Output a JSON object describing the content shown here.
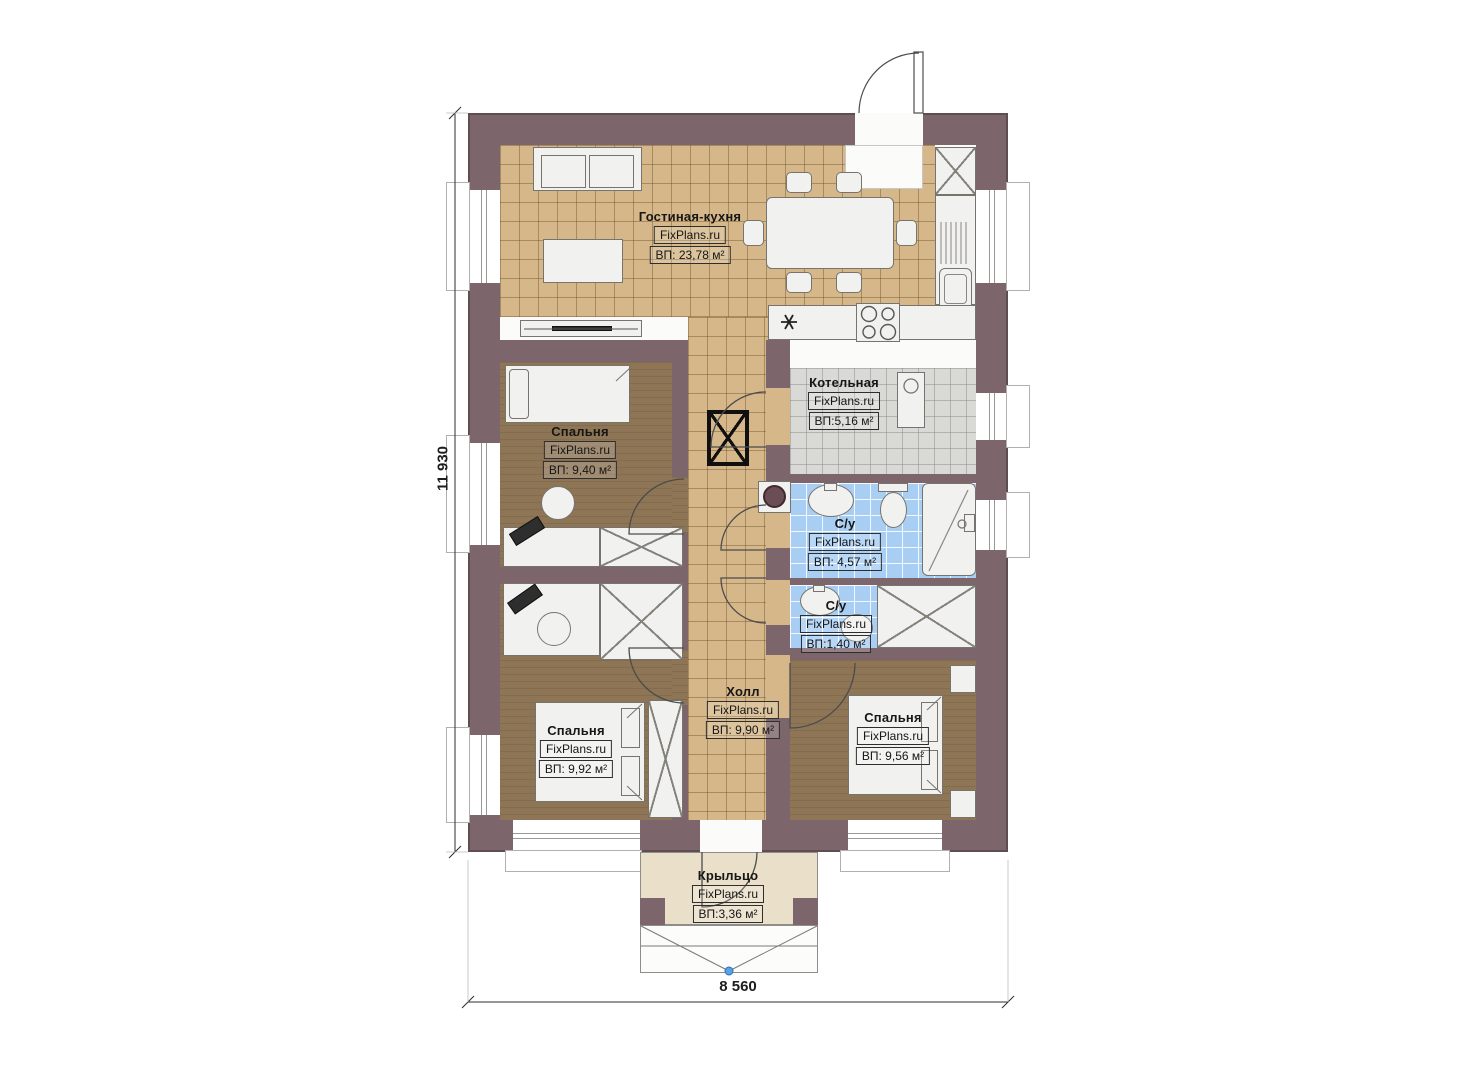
{
  "plan": {
    "dimensions": {
      "height_label": "11 930",
      "width_label": "8 560"
    },
    "colors": {
      "wall": "#7c666b",
      "wall_edge": "#5e4d52",
      "floor_tile_tan": "#d5b78a",
      "floor_bedroom": "#8d7555",
      "floor_bath": "#a9cef3",
      "floor_boiler": "#d9d9d6",
      "floor_porch": "#eadfc9",
      "furniture": "#f1f1ef",
      "accent_dot": "#58a0e8"
    }
  },
  "rooms": [
    {
      "id": "living-kitchen",
      "name": "Гостиная-кухня",
      "watermark": "FixPlans.ru",
      "area": "ВП: 23,78 м²"
    },
    {
      "id": "bedroom-top-left",
      "name": "Спальня",
      "watermark": "FixPlans.ru",
      "area": "ВП: 9,40 м²"
    },
    {
      "id": "boiler-room",
      "name": "Котельная",
      "watermark": "FixPlans.ru",
      "area": "ВП:5,16 м²"
    },
    {
      "id": "bathroom-large",
      "name": "С/у",
      "watermark": "FixPlans.ru",
      "area": "ВП: 4,57 м²"
    },
    {
      "id": "bathroom-small",
      "name": "С/у",
      "watermark": "FixPlans.ru",
      "area": "ВП:1,40 м²"
    },
    {
      "id": "hall",
      "name": "Холл",
      "watermark": "FixPlans.ru",
      "area": "ВП: 9,90 м²"
    },
    {
      "id": "bedroom-bottom-left",
      "name": "Спальня",
      "watermark": "FixPlans.ru",
      "area": "ВП: 9,92 м²"
    },
    {
      "id": "bedroom-bottom-right",
      "name": "Спальня",
      "watermark": "FixPlans.ru",
      "area": "ВП: 9,56 м²"
    },
    {
      "id": "porch",
      "name": "Крыльцо",
      "watermark": "FixPlans.ru",
      "area": "ВП:3,36 м²"
    }
  ]
}
